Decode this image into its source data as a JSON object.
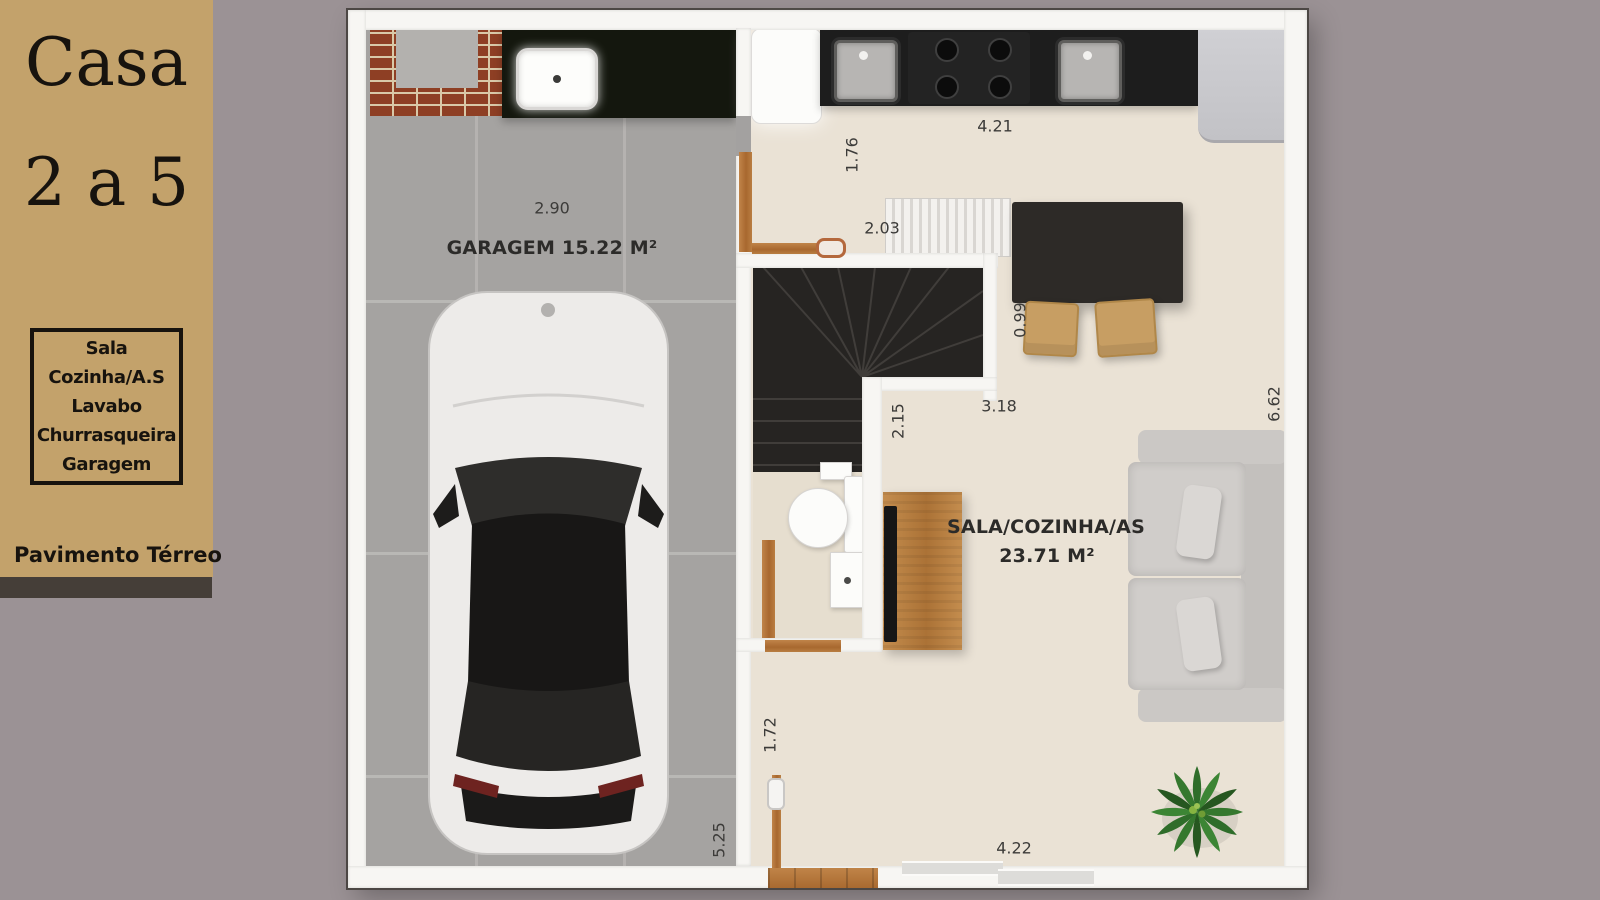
{
  "sidebar": {
    "title_line1": "Casa",
    "title_line2": "2 a 5",
    "features": [
      "Sala",
      "Cozinha/A.S",
      "Lavabo",
      "Churrasqueira",
      "Garagem"
    ],
    "floor_label": "Pavimento Térreo"
  },
  "plan": {
    "garage_label": "GARAGEM 15.22 M²",
    "sala_label_line1": "SALA/COZINHA/AS",
    "sala_label_line2": "23.71 M²",
    "dimensions": [
      {
        "id": "garage-width",
        "value": "2.90",
        "orientation": "horizontal"
      },
      {
        "id": "kitchen-width",
        "value": "4.21",
        "orientation": "horizontal"
      },
      {
        "id": "kitchen-depth",
        "value": "1.76",
        "orientation": "vertical"
      },
      {
        "id": "stair-width",
        "value": "2.03",
        "orientation": "horizontal"
      },
      {
        "id": "table-gap",
        "value": "0.99",
        "orientation": "vertical"
      },
      {
        "id": "stair-length",
        "value": "3.18",
        "orientation": "horizontal"
      },
      {
        "id": "lavabo-depth",
        "value": "2.15",
        "orientation": "vertical"
      },
      {
        "id": "sala-depth",
        "value": "6.62",
        "orientation": "vertical"
      },
      {
        "id": "passage",
        "value": "1.72",
        "orientation": "vertical"
      },
      {
        "id": "garage-depth",
        "value": "5.25",
        "orientation": "vertical"
      },
      {
        "id": "sala-width",
        "value": "4.22",
        "orientation": "horizontal"
      }
    ]
  },
  "colors": {
    "background": "#9b9295",
    "sidebar_bg": "#c3a26b",
    "sidebar_band": "#453e38",
    "floor_beige": "#eae2d5",
    "garage_tile": "#a5a3a1",
    "counter_black": "#1d1d1d",
    "brick": "#8e3f24",
    "wood": "#b0743a",
    "sofa_gray": "#ccc9c6",
    "plant_green": "#367a2e"
  }
}
